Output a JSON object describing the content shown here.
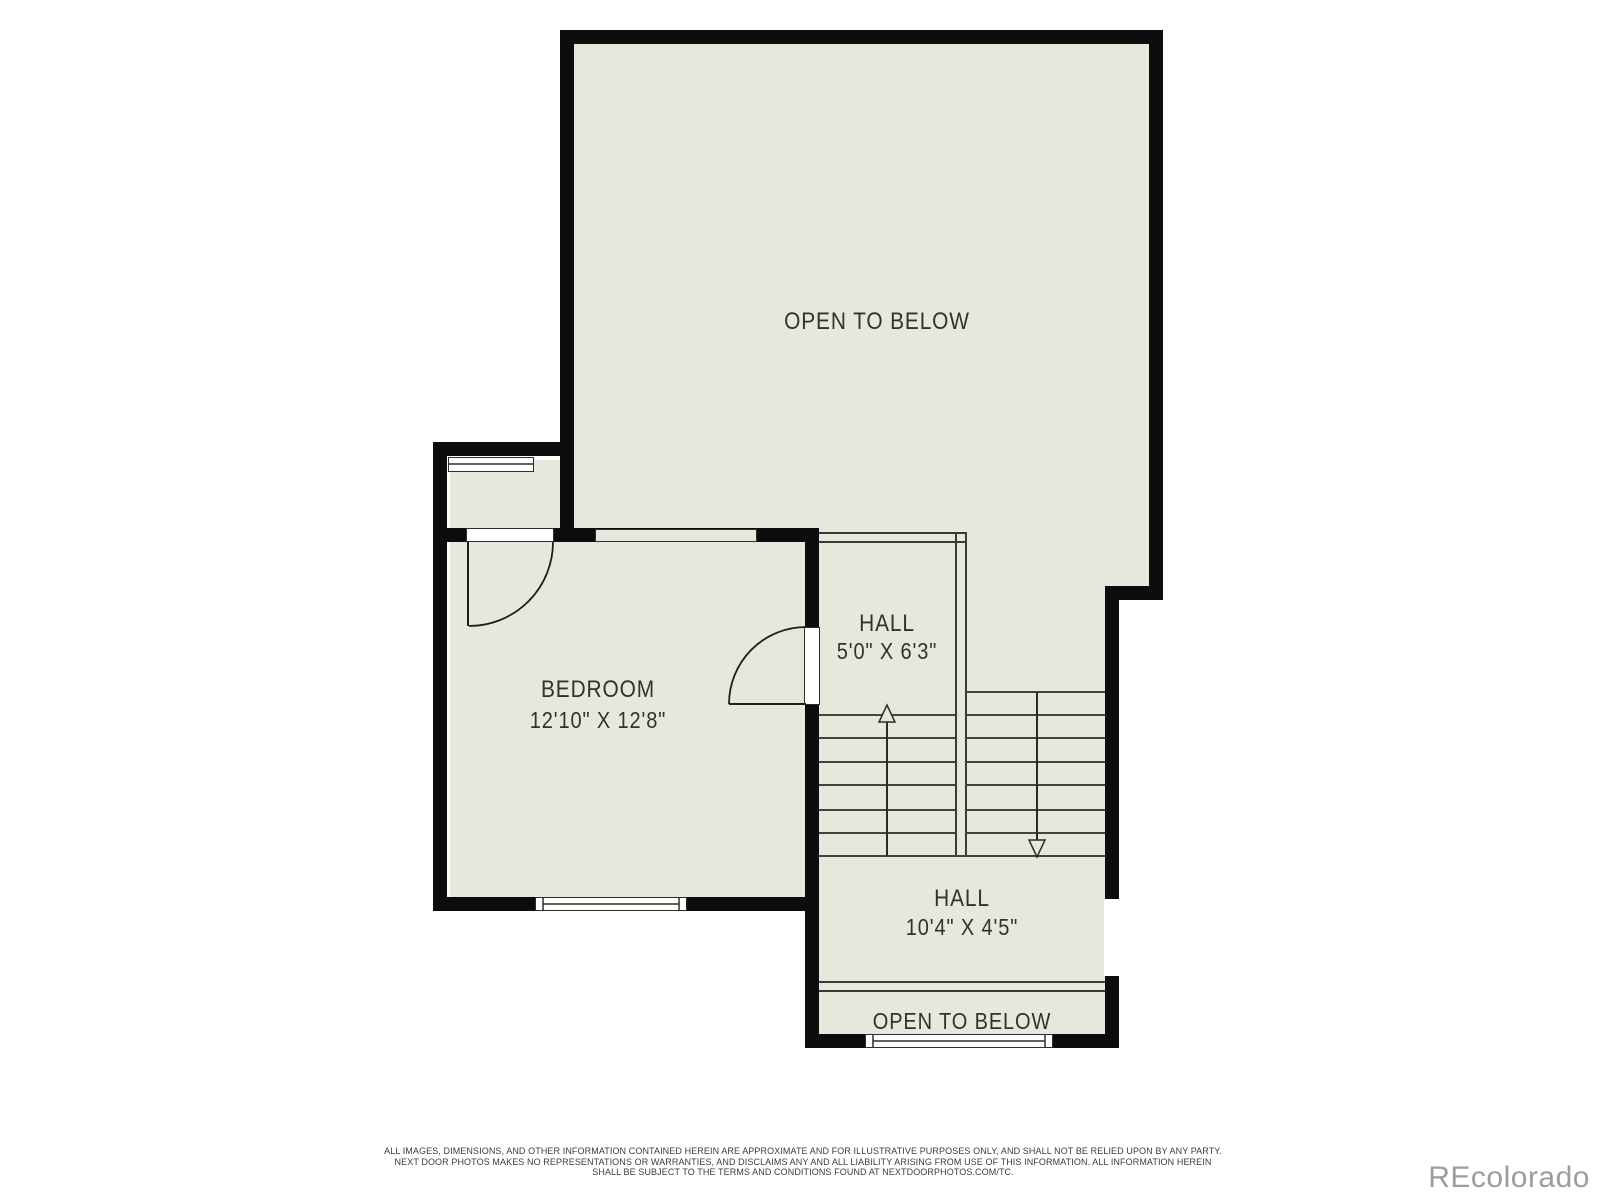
{
  "plan": {
    "rooms": {
      "open_below_main": {
        "label": "OPEN TO BELOW"
      },
      "bedroom": {
        "label": "BEDROOM",
        "dims": "12'10\" X 12'8\""
      },
      "hall_upper": {
        "label": "HALL",
        "dims": "5'0\" X 6'3\""
      },
      "hall_lower": {
        "label": "HALL",
        "dims": "10'4\" X 4'5\""
      },
      "open_below_bottom": {
        "label": "OPEN TO BELOW"
      }
    },
    "stairs": {
      "up_flight_direction": "up",
      "down_flight_direction": "down"
    }
  },
  "disclaimer": {
    "line1": "ALL IMAGES, DIMENSIONS, AND OTHER INFORMATION CONTAINED HEREIN ARE APPROXIMATE AND FOR ILLUSTRATIVE PURPOSES ONLY, AND SHALL NOT BE RELIED UPON BY ANY PARTY.",
    "line2": "NEXT DOOR PHOTOS MAKES NO REPRESENTATIONS OR WARRANTIES, AND DISCLAIMS ANY AND ALL LIABILITY ARISING FROM USE OF THIS INFORMATION. ALL INFORMATION HEREIN",
    "line3": "SHALL BE SUBJECT TO THE TERMS AND CONDITIONS FOUND AT NEXTDOORPHOTOS.COM/TC."
  },
  "watermark": "REcolorado",
  "colors": {
    "wall": "#0d0d0d",
    "room_fill": "#e8e7de",
    "line": "#3b3b33",
    "label_text": "#32322c",
    "disclaimer_text": "#3c3c3c",
    "watermark_text": "#9d9d9d"
  }
}
